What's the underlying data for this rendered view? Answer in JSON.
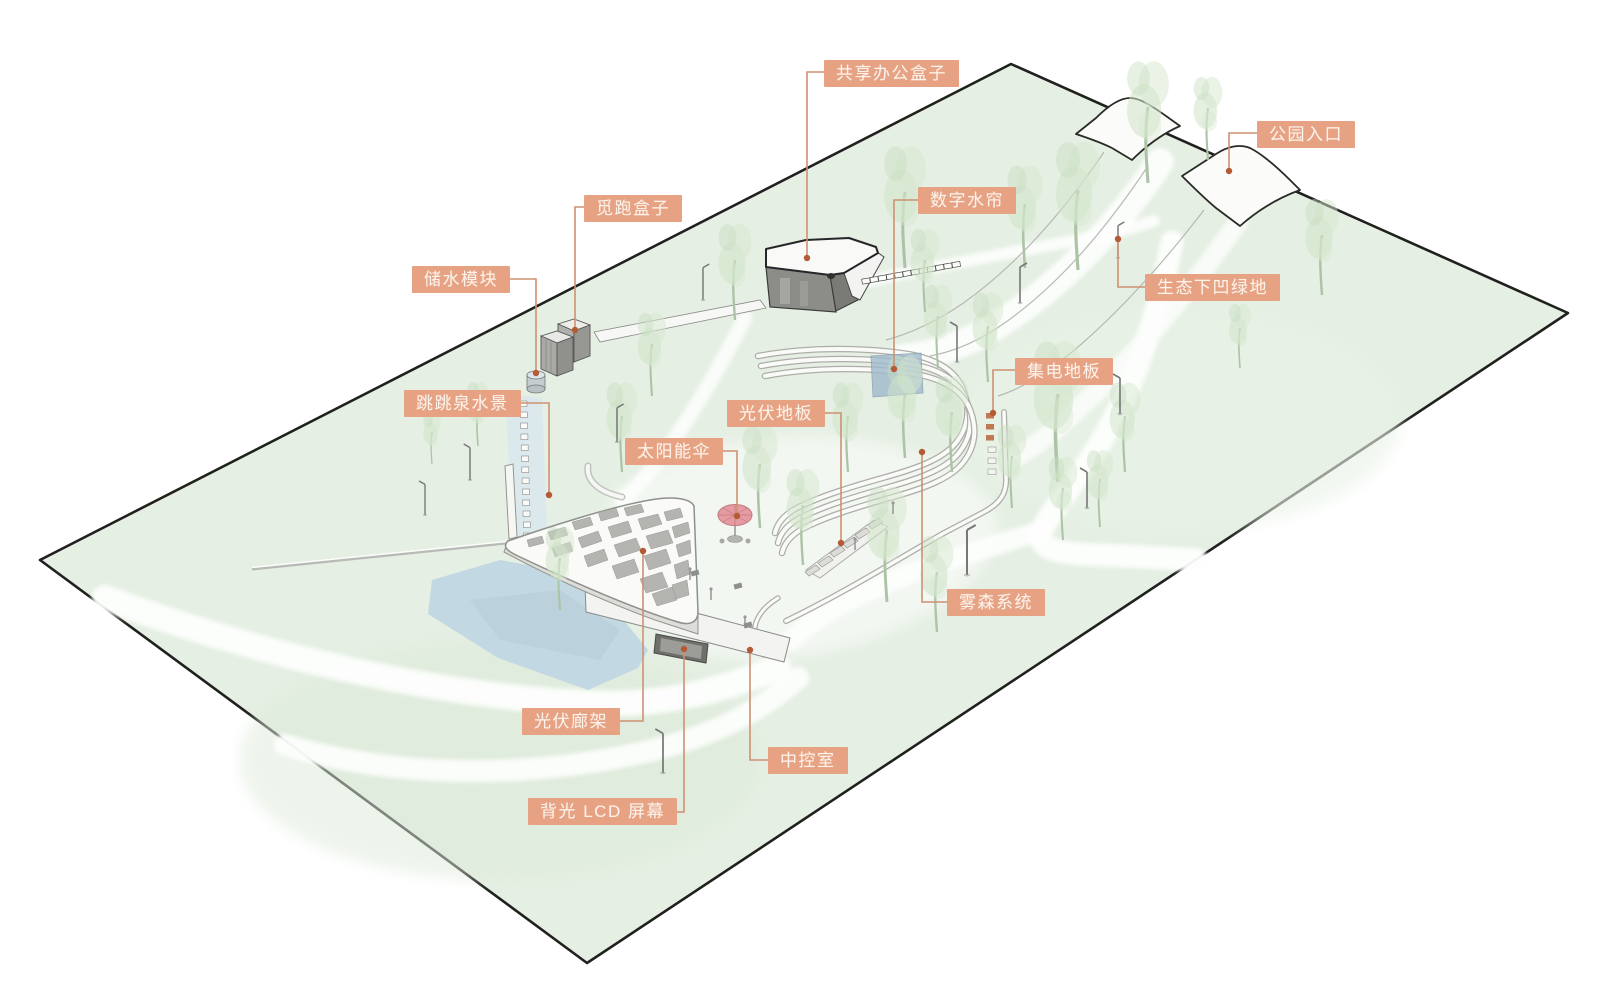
{
  "diagram": {
    "colors": {
      "label_background": "#E7A284",
      "label_text": "#FBF2E9",
      "leader_line": "#CE9172",
      "leader_dot": "#B45B36",
      "site_border": "#20201E",
      "lawn": "#E5EFE3",
      "path_white": "#FDFEFD",
      "water": "#C2D8E2",
      "water_curtain": "#9FBACB",
      "structure_white": "#FAFAF8",
      "structure_gray": "#8C8C88",
      "canopy_hole_gray": "#ADADA9",
      "tree_green": "#CFE3C8",
      "umbrella_pink": "#E59BA1"
    },
    "labels": [
      {
        "id": "shared-office-box",
        "text": "共享办公盒子"
      },
      {
        "id": "park-entrance",
        "text": "公园入口"
      },
      {
        "id": "mipao-box",
        "text": "觅跑盒子"
      },
      {
        "id": "digital-water-curtain",
        "text": "数字水帘"
      },
      {
        "id": "water-storage-module",
        "text": "储水模块"
      },
      {
        "id": "eco-sunken-greenland",
        "text": "生态下凹绿地"
      },
      {
        "id": "jumping-fountain",
        "text": "跳跳泉水景"
      },
      {
        "id": "collector-floor",
        "text": "集电地板"
      },
      {
        "id": "pv-floor",
        "text": "光伏地板"
      },
      {
        "id": "solar-umbrella",
        "text": "太阳能伞"
      },
      {
        "id": "fog-mist-system",
        "text": "雾森系统"
      },
      {
        "id": "pv-gallery-canopy",
        "text": "光伏廊架"
      },
      {
        "id": "control-room",
        "text": "中控室"
      },
      {
        "id": "backlit-lcd-screen",
        "text": "背光 LCD 屏幕"
      }
    ]
  }
}
